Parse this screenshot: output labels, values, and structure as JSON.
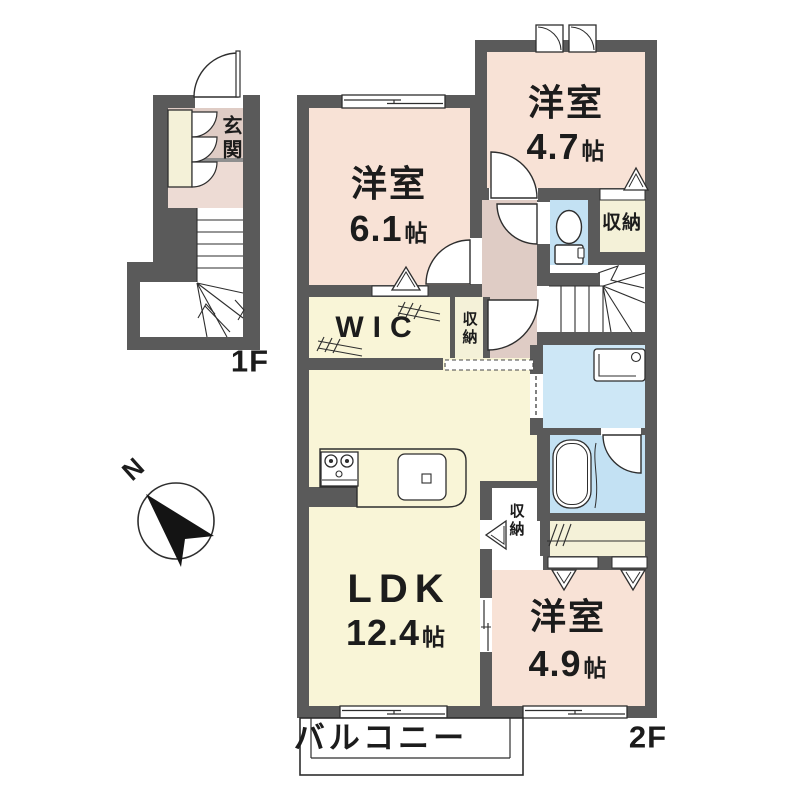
{
  "title": "2LDK apartment floor plan",
  "floor_1f": {
    "label": "1F",
    "genkan_label": "玄関"
  },
  "floor_2f": {
    "label": "2F",
    "rooms": {
      "bedroom_a": {
        "name": "洋室",
        "size": "6.1",
        "unit": "帖"
      },
      "bedroom_b": {
        "name": "洋室",
        "size": "4.7",
        "unit": "帖"
      },
      "bedroom_c": {
        "name": "洋室",
        "size": "4.9",
        "unit": "帖"
      },
      "ldk": {
        "name": "LDK",
        "size": "12.4",
        "unit": "帖"
      },
      "wic_label": "WIC",
      "storage_top_label": "収納",
      "storage_mid_label": "収納",
      "storage_low_label": "収納",
      "balcony_label": "バルコニー"
    }
  },
  "compass": {
    "north_label": "N"
  },
  "colors": {
    "wall": "#5a5a5a",
    "bedroom_pink": "#f8e2d6",
    "hallway_pink": "#dfccc5",
    "living_cream": "#f9f5d7",
    "storage_cream": "#f4f1d8",
    "water_blue": "#c3e1f3",
    "washroom_blue": "#cde7f6",
    "line": "#2e2e2e",
    "text": "#1c1c1c"
  }
}
